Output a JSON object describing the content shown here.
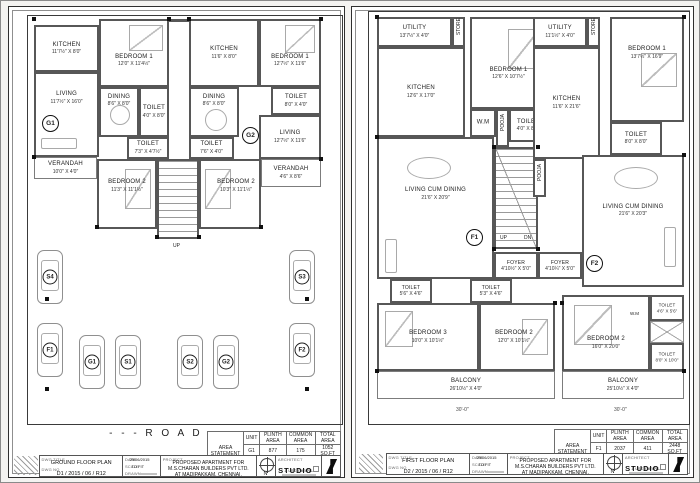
{
  "ground": {
    "rooms": [
      {
        "n": "KITCHEN",
        "d": "11'7½\" X 8'0\""
      },
      {
        "n": "BEDROOM 1",
        "d": "12'0\" X 11'4½\""
      },
      {
        "n": "LIVING",
        "d": "11'7½\" X 16'0\""
      },
      {
        "n": "DINING",
        "d": "8'6\" X 8'0\""
      },
      {
        "n": "TOILET",
        "d": "4'0\" X 8'0\""
      },
      {
        "n": "TOILET",
        "d": "7'3\" X 4'7½\""
      },
      {
        "n": "VERANDAH",
        "d": "10'0\" X 4'0\""
      },
      {
        "n": "BEDROOM 2",
        "d": "11'3\" X 11'1½\""
      },
      {
        "n": "KITCHEN",
        "d": "11'6\" X 8'0\""
      },
      {
        "n": "BEDROOM 1",
        "d": "12'7½\" X 11'6\""
      },
      {
        "n": "DINING",
        "d": "8'6\" X 8'0\""
      },
      {
        "n": "TOILET",
        "d": "8'0\" X 4'0\""
      },
      {
        "n": "LIVING",
        "d": "12'7½\" X 11'6\""
      },
      {
        "n": "TOILET",
        "d": "7'6\" X 4'0\""
      },
      {
        "n": "BEDROOM 2",
        "d": "10'3\" X 11'1½\""
      },
      {
        "n": "VERANDAH",
        "d": "4'6\" X 8'6\""
      }
    ],
    "units": [
      "G1",
      "G2"
    ],
    "up": "UP",
    "cars": [
      "S4",
      "S3",
      "F1",
      "G1",
      "S1",
      "S2",
      "G2",
      "F2"
    ],
    "road": "- - - R O A D - - -"
  },
  "first": {
    "rooms": [
      {
        "n": "UTILITY",
        "d": "13'7½\" X 4'0\""
      },
      {
        "n": "KITCHEN",
        "d": "12'6\" X 17'0\""
      },
      {
        "n": "BEDROOM 1",
        "d": "12'6\" X 10'7½\""
      },
      {
        "n": "W.M",
        "d": ""
      },
      {
        "n": "TOILET",
        "d": "4'0\" X 8'0\""
      },
      {
        "n": "LIVING CUM DINING",
        "d": "21'6\" X 20'9\""
      },
      {
        "n": "FOYER",
        "d": "4'10½\" X 5'0\""
      },
      {
        "n": "UTILITY",
        "d": "11'1½\" X 4'0\""
      },
      {
        "n": "KITCHEN",
        "d": "11'6\" X 21'6\""
      },
      {
        "n": "BEDROOM 1",
        "d": "13'7½\" X 16'9\""
      },
      {
        "n": "TOILET",
        "d": "8'0\" X 8'0\""
      },
      {
        "n": "LIVING CUM DINING",
        "d": "21'6\" X 20'3\""
      },
      {
        "n": "FOYER",
        "d": "4'10¼\" X 5'0\""
      },
      {
        "n": "TOILET",
        "d": "5'6\" X 4'6\""
      },
      {
        "n": "TOILET",
        "d": "5'3\" X 4'6\""
      },
      {
        "n": "BEDROOM 3",
        "d": "10'0\" X 10'1½\""
      },
      {
        "n": "BEDROOM 2",
        "d": "12'0\" X 10'1½\""
      },
      {
        "n": "BALCONY",
        "d": "26'10½\" X 4'0\""
      },
      {
        "n": "BEDROOM 2",
        "d": "16'0\" X 20'0\""
      },
      {
        "n": "TOILET",
        "d": "4'6\" X 5'6\""
      },
      {
        "n": "W.M",
        "d": ""
      },
      {
        "n": "TOILET",
        "d": "8'0\" X 10'0\""
      },
      {
        "n": "BALCONY",
        "d": "25'10½\" X 4'0\""
      }
    ],
    "units": [
      "F1",
      "F2"
    ],
    "up": "UP",
    "dn": "DN",
    "store": "STORE",
    "pooja": "POOJA",
    "dim30": "30'-0\""
  },
  "tb": {
    "ground": {
      "table": {
        "title": "AREA STATEMENT",
        "cols": [
          "UNIT",
          "PLINTH AREA",
          "COMMON AREA",
          "TOTAL AREA"
        ],
        "rows": [
          [
            "G1",
            "877",
            "175",
            "1052 SQ.FT"
          ],
          [
            "G2",
            "878",
            "176",
            "1054 SQ.FT"
          ]
        ]
      },
      "dwg_title_label": "DWG TITLE",
      "dwg_title": "GROUND FLOOR PLAN",
      "dwg_no_label": "DWG NO",
      "dwg_no": "D1 / 2015 / 06 / R12",
      "date_label": "DATE",
      "date": "29/06/2015",
      "scale_label": "SCALE",
      "scale": "TO FIT",
      "drawn_label": "DRAWN",
      "project_label": "PROJECT",
      "project1": "PROPOSED APARTMENT FOR",
      "project2": "M.S.CHARAN BUILDERS PVT LTD.",
      "project3": "AT MADIPAKKAM, CHENNAI.",
      "north": "N",
      "architect_label": "ARCHITECT",
      "studio": "STUDIO",
      "studio_sub": "a unit from NL"
    },
    "first": {
      "table": {
        "title": "AREA STATEMENT",
        "cols": [
          "UNIT",
          "PLINTH AREA",
          "COMMON AREA",
          "TOTAL AREA"
        ],
        "rows": [
          [
            "F1",
            "2037",
            "411",
            "2448 SQ.FT"
          ],
          [
            "F2",
            "2055",
            "411",
            "2466 SQ.FT"
          ]
        ]
      },
      "dwg_title_label": "DWG TITLE",
      "dwg_title": "FIRST FLOOR PLAN",
      "dwg_no_label": "DWG NO",
      "dwg_no": "D2 / 2015 / 06 / R12",
      "date_label": "DATE",
      "date": "29/06/2015",
      "scale_label": "SCALE",
      "scale": "TO FIT",
      "drawn_label": "DRAWN",
      "project_label": "PROJECT",
      "project1": "PROPOSED APARTMENT FOR",
      "project2": "M.S.CHARAN BUILDERS PVT LTD.",
      "project3": "AT MADIPAKKAM, CHENNAI.",
      "north": "N",
      "architect_label": "ARCHITECT",
      "studio": "STUDIO",
      "studio_sub": "a unit from NL"
    }
  }
}
